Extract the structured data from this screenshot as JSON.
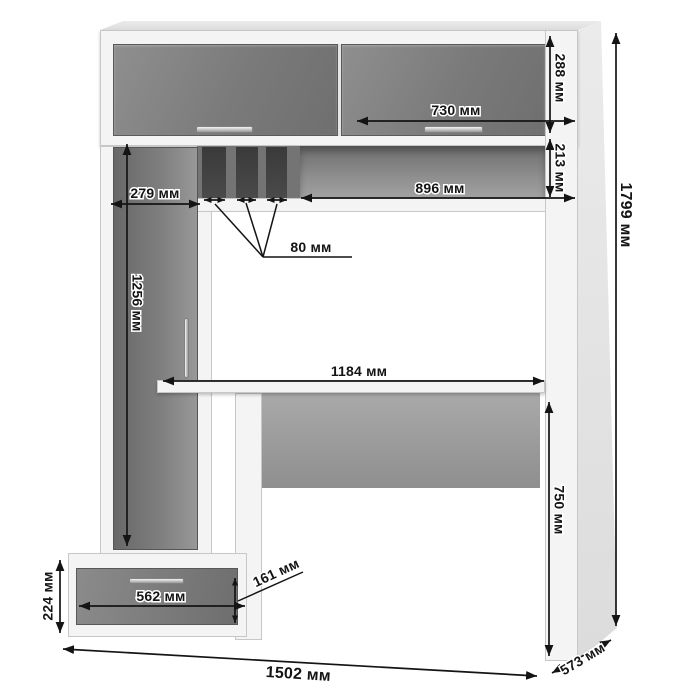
{
  "diagram": {
    "kind": "furniture-dimension-drawing",
    "units": "мм"
  },
  "dims": {
    "upper_cabinet_height_288": "288 мм",
    "upper_door_width_730": "730 мм",
    "niche_height_213": "213 мм",
    "niche_width_896": "896 мм",
    "tall_cabinet_width_279": "279 мм",
    "slot_width_80": "80 мм",
    "tall_door_height_1256": "1256 мм",
    "desktop_width_1184": "1184 мм",
    "total_height_1799": "1799 мм",
    "desk_height_750": "750 мм",
    "pedestal_height_224": "224 мм",
    "drawer_width_562": "562 мм",
    "drawer_height_161": "161 мм",
    "total_width_1502": "1502 мм",
    "depth_573": "573 мм"
  },
  "colors": {
    "front_panel_gray": "#7d7d7d",
    "carcass_white": "#f4f4f4",
    "slot_dark": "#3f3f3f",
    "niche_back": "#8d8d8d",
    "dimension_line": "#141414",
    "background": "#ffffff"
  }
}
